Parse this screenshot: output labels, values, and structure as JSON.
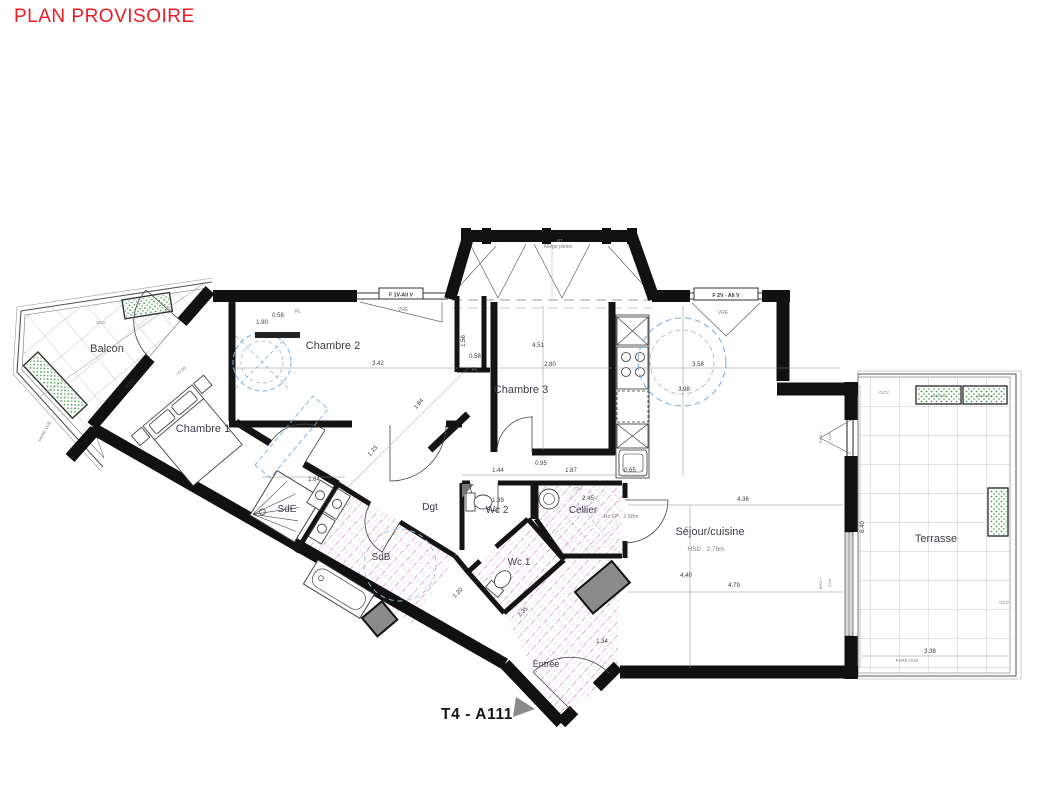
{
  "title": "PLAN PROVISOIRE",
  "plan_id": "T4 - A111",
  "colors": {
    "title_red": "#ed1c24",
    "wall_black": "#111111",
    "hatch_pink": "#c668ab",
    "furniture_blue": "#7ab0e0",
    "planter_green": "#3f9b3f",
    "shaft_gray": "#8a8a8a",
    "tile_gray": "#b3b3b3"
  },
  "rooms": [
    {
      "id": "balcon",
      "label": "Balcon",
      "x": 107,
      "y": 352,
      "fs": 11
    },
    {
      "id": "chambre1",
      "label": "Chambre 1",
      "x": 203,
      "y": 432,
      "fs": 11
    },
    {
      "id": "chambre2",
      "label": "Chambre 2",
      "x": 333,
      "y": 349,
      "fs": 11
    },
    {
      "id": "chambre3",
      "label": "Chambre 3",
      "x": 521,
      "y": 393,
      "fs": 11
    },
    {
      "id": "sde",
      "label": "SdE",
      "x": 287,
      "y": 512,
      "fs": 10
    },
    {
      "id": "sdb",
      "label": "SdB",
      "x": 381,
      "y": 560,
      "fs": 10
    },
    {
      "id": "dgt",
      "label": "Dgt",
      "x": 430,
      "y": 510,
      "fs": 10
    },
    {
      "id": "wc2",
      "label": "Wc 2",
      "x": 497,
      "y": 513,
      "fs": 10
    },
    {
      "id": "wc1",
      "label": "Wc 1",
      "x": 519,
      "y": 565,
      "fs": 10
    },
    {
      "id": "cellier",
      "label": "Cellier",
      "x": 583,
      "y": 513,
      "fs": 10
    },
    {
      "id": "entree",
      "label": "Entrée",
      "x": 546,
      "y": 667,
      "fs": 9
    },
    {
      "id": "sejour",
      "label": "Séjour/cuisine",
      "x": 710,
      "y": 535,
      "fs": 11
    },
    {
      "id": "terrasse",
      "label": "Terrasse",
      "x": 936,
      "y": 542,
      "fs": 11
    }
  ],
  "window_labels": [
    {
      "id": "window-f1v",
      "label": "F 1V-All V",
      "x": 401,
      "y": 296.5
    },
    {
      "id": "window-f2v",
      "label": "F 2V - All V",
      "x": 726,
      "y": 297
    }
  ],
  "annotations": [
    {
      "id": "hsd-sejour",
      "t": "HSD : 2.76m",
      "x": 706,
      "y": 551,
      "fs": 6.5,
      "c": "#9a9aa6"
    },
    {
      "id": "hsfp-cellier",
      "t": "Hs FP : 2.58m",
      "x": 621,
      "y": 518,
      "fs": 5.5,
      "c": "#9a9aa6"
    },
    {
      "id": "allege-pleine",
      "t": "Allège pleine",
      "x": 558,
      "y": 248,
      "fs": 5,
      "c": "#8a8a8a"
    },
    {
      "id": "bt-marker",
      "t": "BT",
      "x": 560,
      "y": 242,
      "fs": 4.5,
      "c": "#4a7fd4"
    },
    {
      "id": "vre-left",
      "t": "VRE",
      "x": 403,
      "y": 311,
      "fs": 5,
      "c": "#666666"
    },
    {
      "id": "vre-right",
      "t": "VRE",
      "x": 723,
      "y": 314,
      "fs": 5,
      "c": "#666666"
    },
    {
      "id": "pl-top",
      "t": "PL",
      "x": 298,
      "y": 313,
      "fs": 5,
      "c": "#666666"
    },
    {
      "id": "pl-column",
      "t": "PL",
      "x": 475,
      "y": 371,
      "fs": 5,
      "c": "#666666"
    },
    {
      "id": "scv-balcon",
      "t": "SCV",
      "x": 101,
      "y": 324,
      "fs": 4.5,
      "c": "#8a8a8a"
    },
    {
      "id": "gcv-terrasse1",
      "t": "GCV",
      "x": 884,
      "y": 394,
      "fs": 4.5,
      "c": "#8a8a8a"
    },
    {
      "id": "gcv-terrasse2",
      "t": "GCV",
      "x": 1004,
      "y": 604,
      "fs": 4.5,
      "c": "#8a8a8a"
    },
    {
      "id": "parevue-terr",
      "t": "PARE-VUE",
      "x": 907,
      "y": 662,
      "fs": 4.5,
      "c": "#707070"
    },
    {
      "id": "parevue-balc",
      "t": "PARE-VUE",
      "x": 46,
      "y": 432,
      "fs": 4.5,
      "c": "#707070",
      "r": -62
    },
    {
      "id": "jardiniere-1",
      "t": "jardinière",
      "x": 939,
      "y": 397,
      "fs": 4,
      "c": "#467d46"
    },
    {
      "id": "jardiniere-2",
      "t": "jardinière",
      "x": 985,
      "y": 397,
      "fs": 4,
      "c": "#467d46"
    },
    {
      "id": "bso-top",
      "t": "BSO +",
      "x": 822,
      "y": 437,
      "fs": 4,
      "c": "#8a8a8a",
      "r": -90
    },
    {
      "id": "h304-top",
      "t": "3.04",
      "x": 831,
      "y": 437,
      "fs": 4,
      "c": "#8a8a8a",
      "r": -90
    },
    {
      "id": "bso-bottom",
      "t": "BSO +",
      "x": 822,
      "y": 583,
      "fs": 4,
      "c": "#8a8a8a",
      "r": -90
    },
    {
      "id": "h304-bottom",
      "t": "3.04",
      "x": 831,
      "y": 583,
      "fs": 4,
      "c": "#8a8a8a",
      "r": -90
    },
    {
      "id": "level-balcon",
      "t": "+0.09",
      "x": 182,
      "y": 372,
      "fs": 4.5,
      "c": "#707070",
      "r": -40
    },
    {
      "id": "cbc-cellier",
      "t": "Cbc",
      "x": 578,
      "y": 490,
      "fs": 4.5,
      "c": "#8a8a8a"
    }
  ],
  "dimensions": [
    {
      "t": "4.60",
      "x": 131,
      "y": 385,
      "r": -40
    },
    {
      "t": "1.90",
      "x": 262,
      "y": 324
    },
    {
      "t": "0.58",
      "x": 278,
      "y": 317
    },
    {
      "t": "3.42",
      "x": 378,
      "y": 365
    },
    {
      "t": "1.56",
      "x": 465,
      "y": 341,
      "r": -90
    },
    {
      "t": "0.58",
      "x": 475,
      "y": 358
    },
    {
      "t": "4.51",
      "x": 538,
      "y": 347
    },
    {
      "t": "2.80",
      "x": 550,
      "y": 366
    },
    {
      "t": "3.58",
      "x": 698,
      "y": 366
    },
    {
      "t": "3.98",
      "x": 684,
      "y": 391
    },
    {
      "t": "0.95",
      "x": 541,
      "y": 465
    },
    {
      "t": "1.44",
      "x": 498,
      "y": 472
    },
    {
      "t": "1.87",
      "x": 571,
      "y": 472
    },
    {
      "t": "0.65",
      "x": 630,
      "y": 472
    },
    {
      "t": "4.36",
      "x": 743,
      "y": 501
    },
    {
      "t": "4.40",
      "x": 686,
      "y": 577
    },
    {
      "t": "4.79",
      "x": 734,
      "y": 587
    },
    {
      "t": "6.40",
      "x": 864,
      "y": 527,
      "r": -90
    },
    {
      "t": "3.38",
      "x": 930,
      "y": 653
    },
    {
      "t": "1.64",
      "x": 314,
      "y": 481
    },
    {
      "t": "1.23",
      "x": 374,
      "y": 452,
      "r": -50
    },
    {
      "t": "1.84",
      "x": 420,
      "y": 405,
      "r": -50
    },
    {
      "t": "1.39",
      "x": 498,
      "y": 502
    },
    {
      "t": "2.45",
      "x": 588,
      "y": 500
    },
    {
      "t": "1.34",
      "x": 602,
      "y": 643
    },
    {
      "t": "2.35",
      "x": 524,
      "y": 613,
      "r": -45
    },
    {
      "t": "1.20",
      "x": 459,
      "y": 594,
      "r": -45
    }
  ]
}
